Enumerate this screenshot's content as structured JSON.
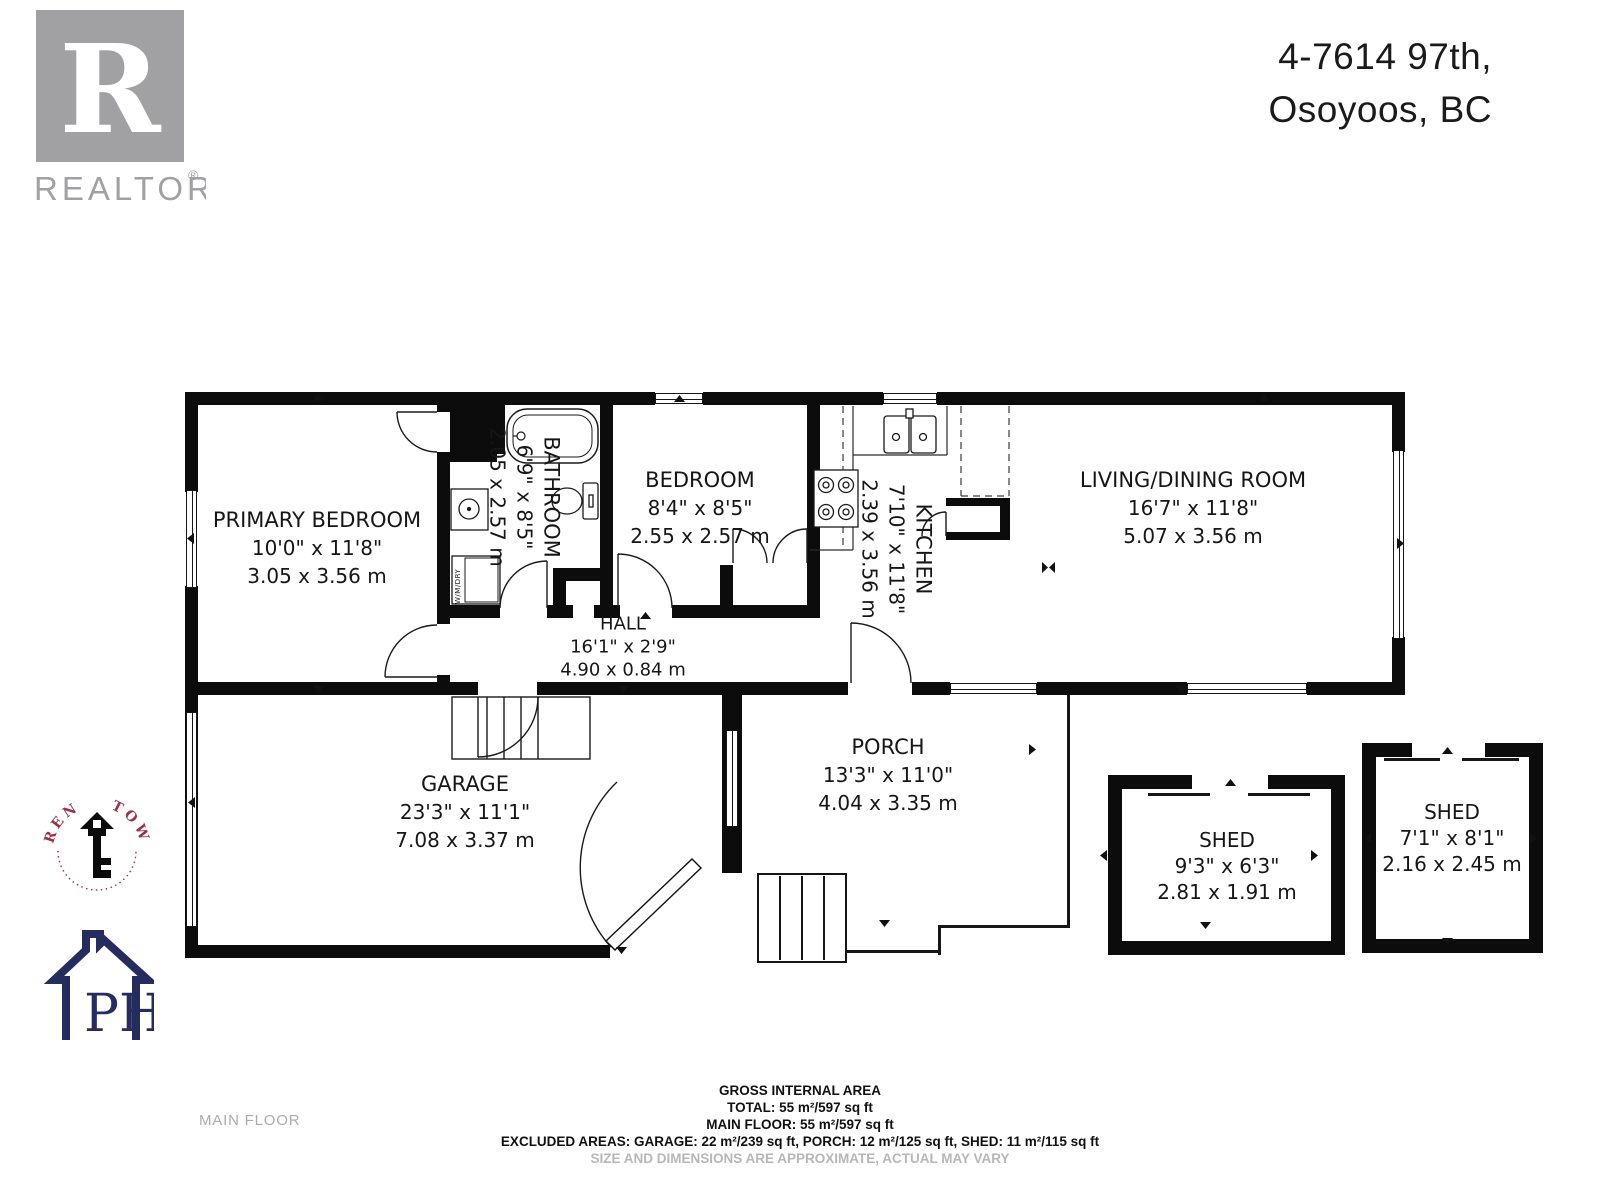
{
  "header": {
    "address_line1": "4-7614 97th,",
    "address_line2": "Osoyoos, BC",
    "realtor_wordmark": "REALTOR",
    "realtor_mark": "®",
    "realtor_letter": "R"
  },
  "floor_label": "MAIN FLOOR",
  "rooms": [
    {
      "name": "PRIMARY BEDROOM",
      "imperial": "10'0\" x 11'8\"",
      "metric": "3.05 x 3.56 m"
    },
    {
      "name": "BATHROOM",
      "imperial": "6'9\" x 8'5\"",
      "metric": "2.05 x 2.57 m"
    },
    {
      "name": "BEDROOM",
      "imperial": "8'4\" x 8'5\"",
      "metric": "2.55 x 2.57 m"
    },
    {
      "name": "HALL",
      "imperial": "16'1\" x 2'9\"",
      "metric": "4.90 x 0.84 m"
    },
    {
      "name": "KITCHEN",
      "imperial": "7'10\" x 11'8\"",
      "metric": "2.39 x 3.56 m"
    },
    {
      "name": "LIVING/DINING ROOM",
      "imperial": "16'7\" x 11'8\"",
      "metric": "5.07 x 3.56 m"
    },
    {
      "name": "GARAGE",
      "imperial": "23'3\" x 11'1\"",
      "metric": "7.08 x 3.37 m"
    },
    {
      "name": "PORCH",
      "imperial": "13'3\" x 11'0\"",
      "metric": "4.04 x 3.35 m"
    },
    {
      "name": "SHED",
      "imperial": "9'3\" x 6'3\"",
      "metric": "2.81 x 1.91 m"
    },
    {
      "name": "SHED",
      "imperial": "7'1\" x 8'1\"",
      "metric": "2.16 x 2.45 m"
    }
  ],
  "fixtures": {
    "washer_dryer": "W/M/DRY"
  },
  "footer": {
    "line1": "GROSS INTERNAL AREA",
    "line2": "TOTAL: 55 m²/597 sq ft",
    "line3": "MAIN FLOOR: 55 m²/597 sq ft",
    "line4": "EXCLUDED AREAS: GARAGE: 22 m²/239 sq ft, PORCH: 12 m²/125 sq ft, SHED: 11 m²/115 sq ft",
    "line5": "SIZE AND DIMENSIONS ARE APPROXIMATE, ACTUAL MAY VARY"
  },
  "logos": {
    "lauren_towers": "LAUREN TOWERS",
    "ph": "PH"
  },
  "colors": {
    "wall": "#0c0c0c",
    "realtor_gray": "#a1a1a4",
    "lauren_maroon": "#983349",
    "ph_navy": "#252c5e",
    "footer_muted": "#b7b7b7"
  }
}
